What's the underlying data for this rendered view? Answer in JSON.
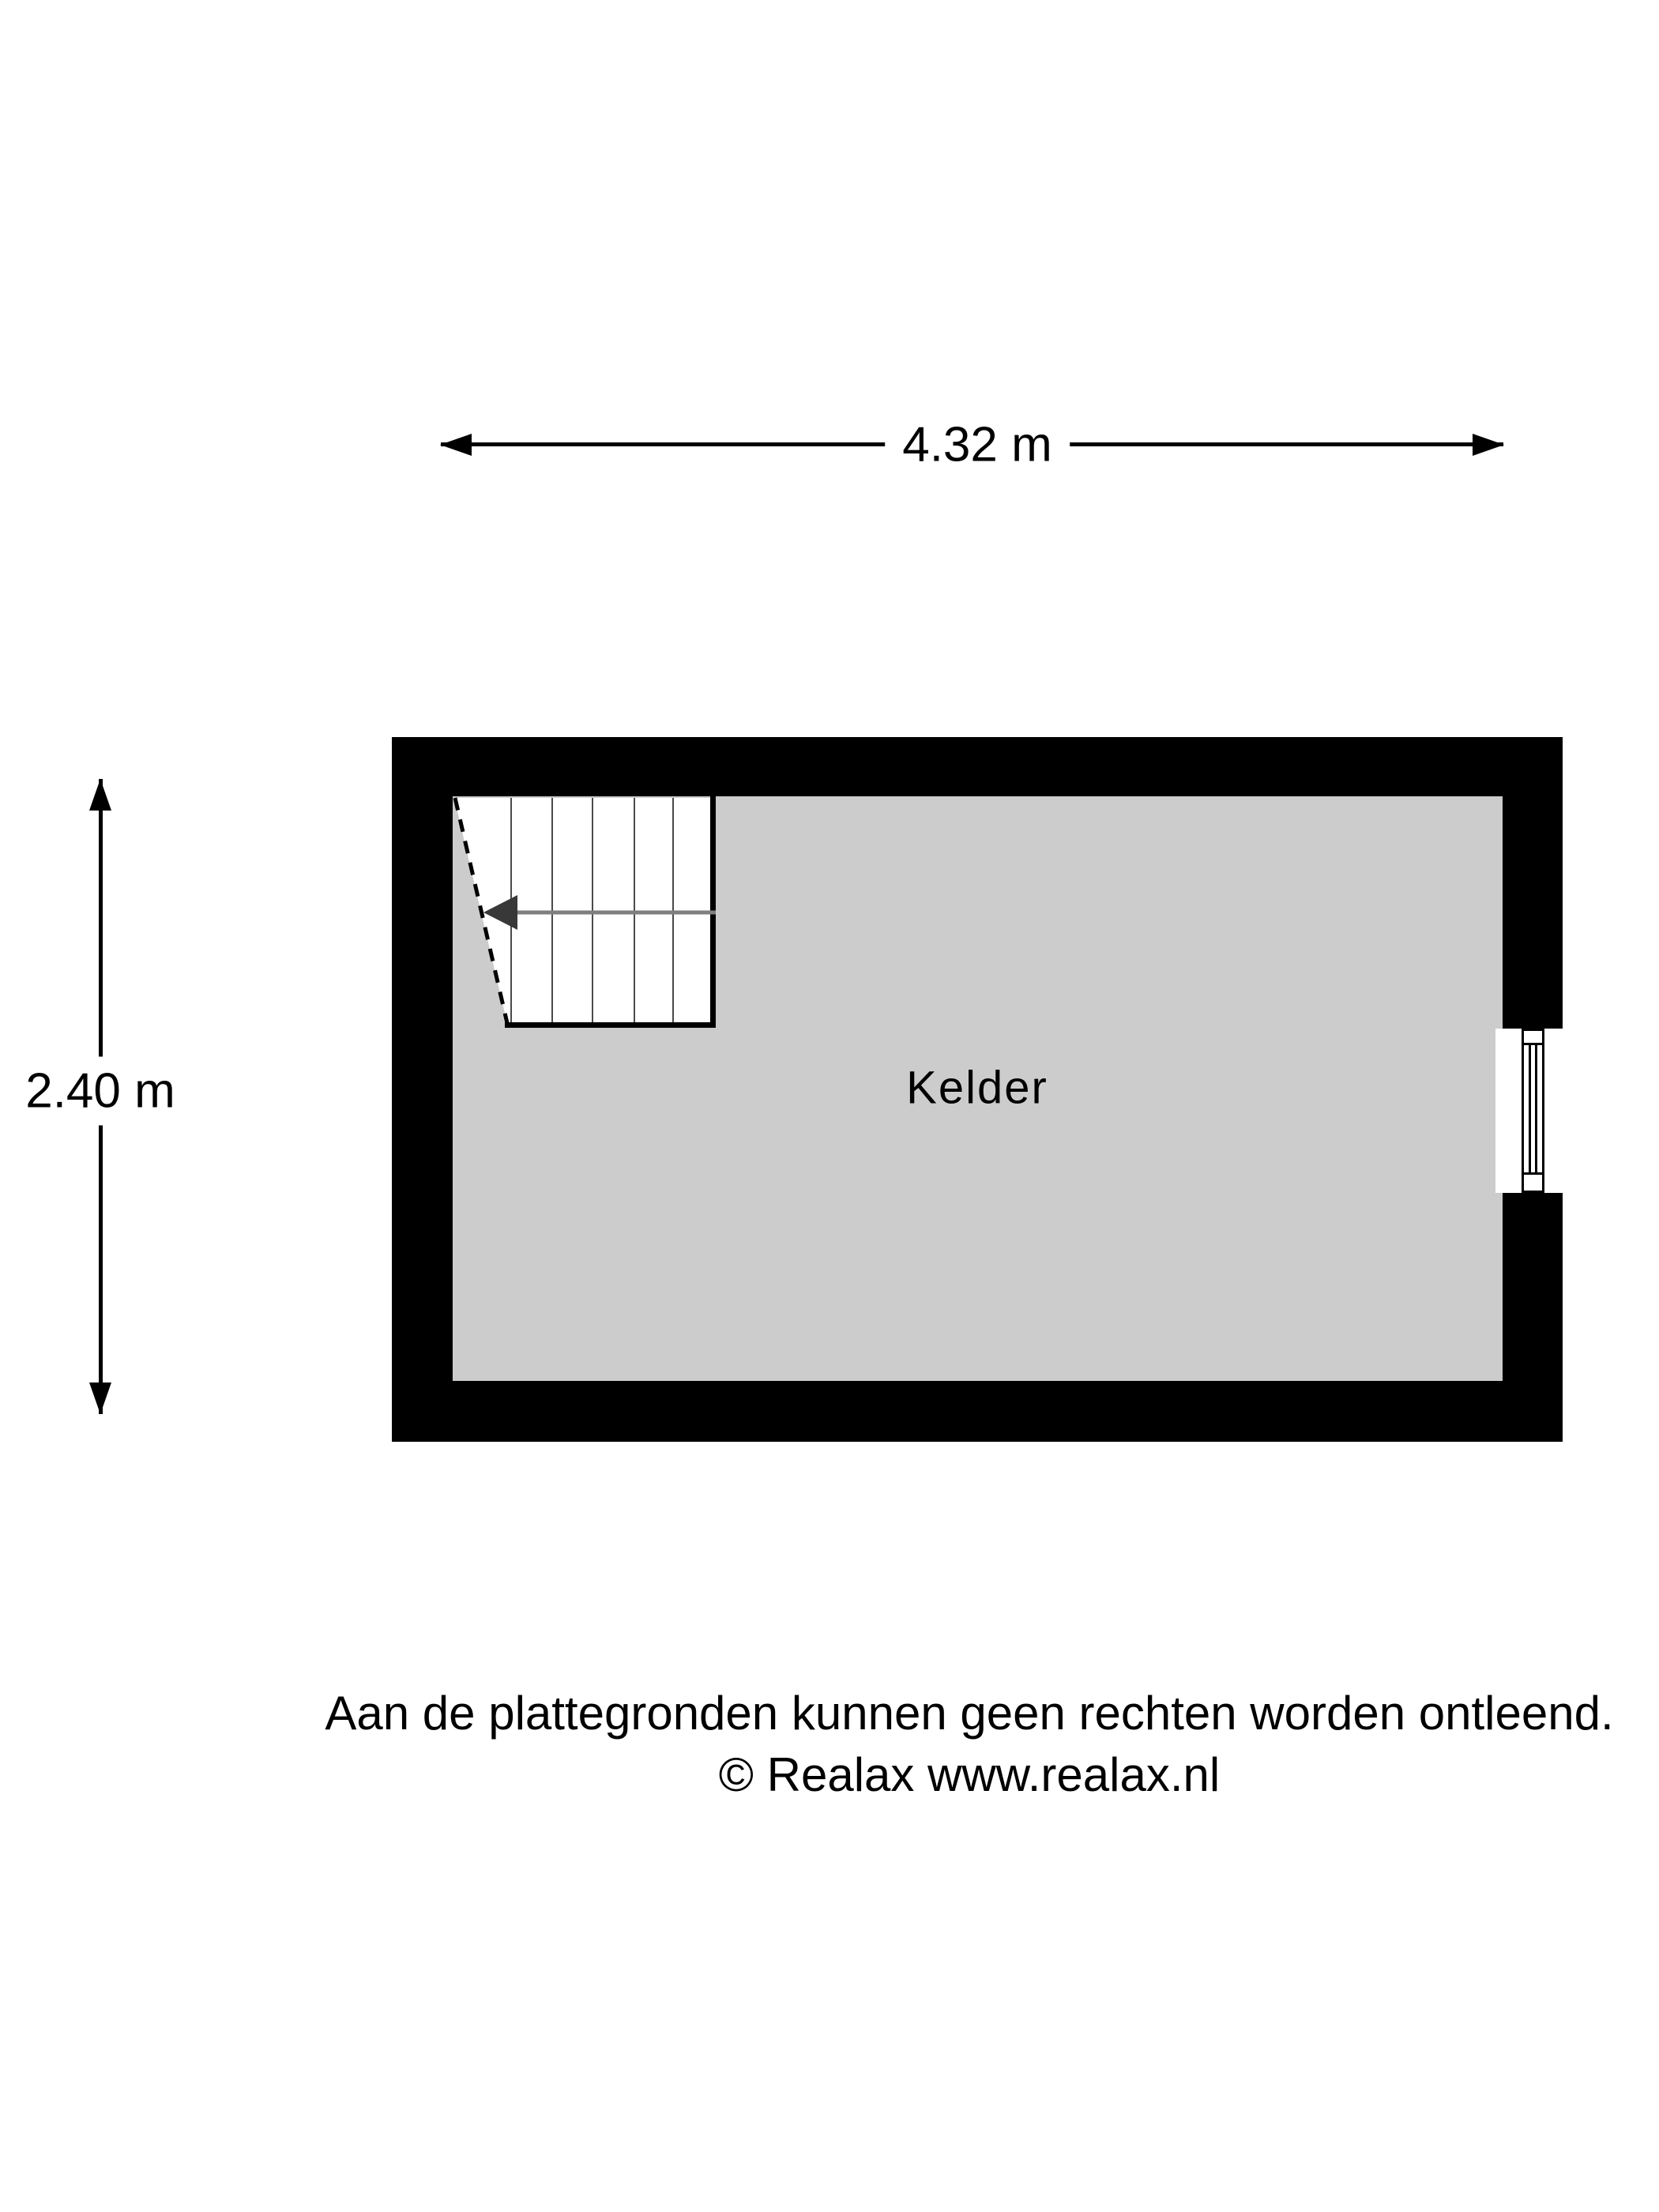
{
  "dimensions": {
    "width_label": "4.32 m",
    "height_label": "2.40 m"
  },
  "room": {
    "label": "Kelder"
  },
  "footer": {
    "line1": "Aan de plattegronden kunnen geen rechten worden ontleend.",
    "line2": "© Realax www.realax.nl"
  },
  "colors": {
    "wall": "#000000",
    "floor": "#cccccc",
    "stair_arrow": "#7f7f7f",
    "tread": "#4a4a4a"
  }
}
